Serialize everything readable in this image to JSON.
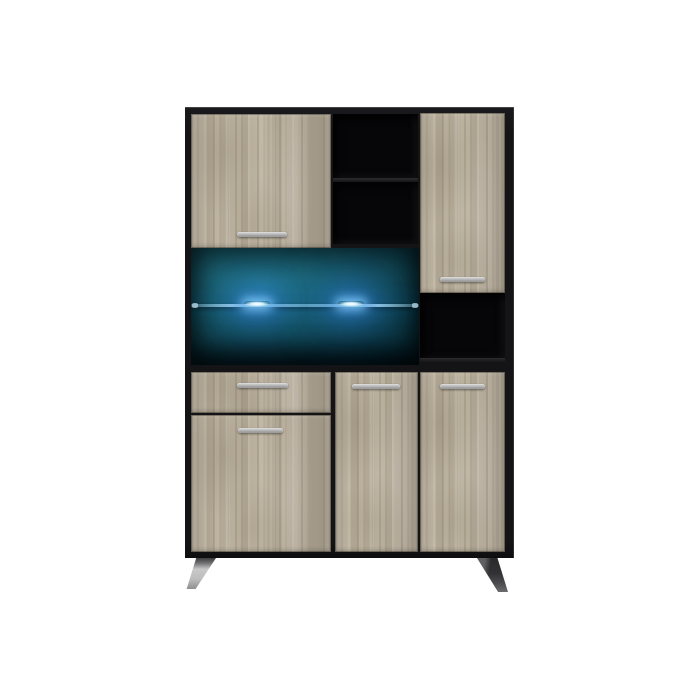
{
  "scene": {
    "description": "Studio product photo of a tall buffet display cabinet on a plain white background. Black matte carcass with light grey-oak wood-grain fronts, an open LED-lit display compartment with a glass shelf and two glowing blue LED spots over a teal back panel, open black niches, slim silver bar handles and angled metal feet.",
    "background_color": "#ffffff"
  },
  "colors": {
    "frame": "#141417",
    "opening": "#060608",
    "oak_base": "#bdb3a1",
    "handle_light": "#dcdcdc",
    "handle_dark": "#8a8a8a",
    "display_teal": "#19606c",
    "display_teal_dark": "#041820",
    "glass_line": "#bfe9ff",
    "led_core": "#d9f2ff",
    "led_glow": "#3f9fff",
    "leg_silver": "#bdbdbe",
    "leg_dark": "#323234",
    "page_bg": "#ffffff"
  },
  "cabinet": {
    "led_count": 2,
    "handle_count": 6,
    "parts": [
      {
        "label": "top left oak door with horizontal silver handle"
      },
      {
        "label": "open middle shelf niche with one shelf"
      },
      {
        "label": "tall top right oak door with horizontal silver handle"
      },
      {
        "label": "LED display compartment with teal back panel, glass shelf and two blue LED lights"
      },
      {
        "label": "open black niche under right door"
      },
      {
        "label": "left drawer with horizontal silver handle"
      },
      {
        "label": "bottom left oak door with horizontal silver handle"
      },
      {
        "label": "bottom middle oak door with horizontal silver handle"
      },
      {
        "label": "bottom right oak door with horizontal silver handle"
      },
      {
        "label": "two angled metal feet"
      }
    ]
  }
}
